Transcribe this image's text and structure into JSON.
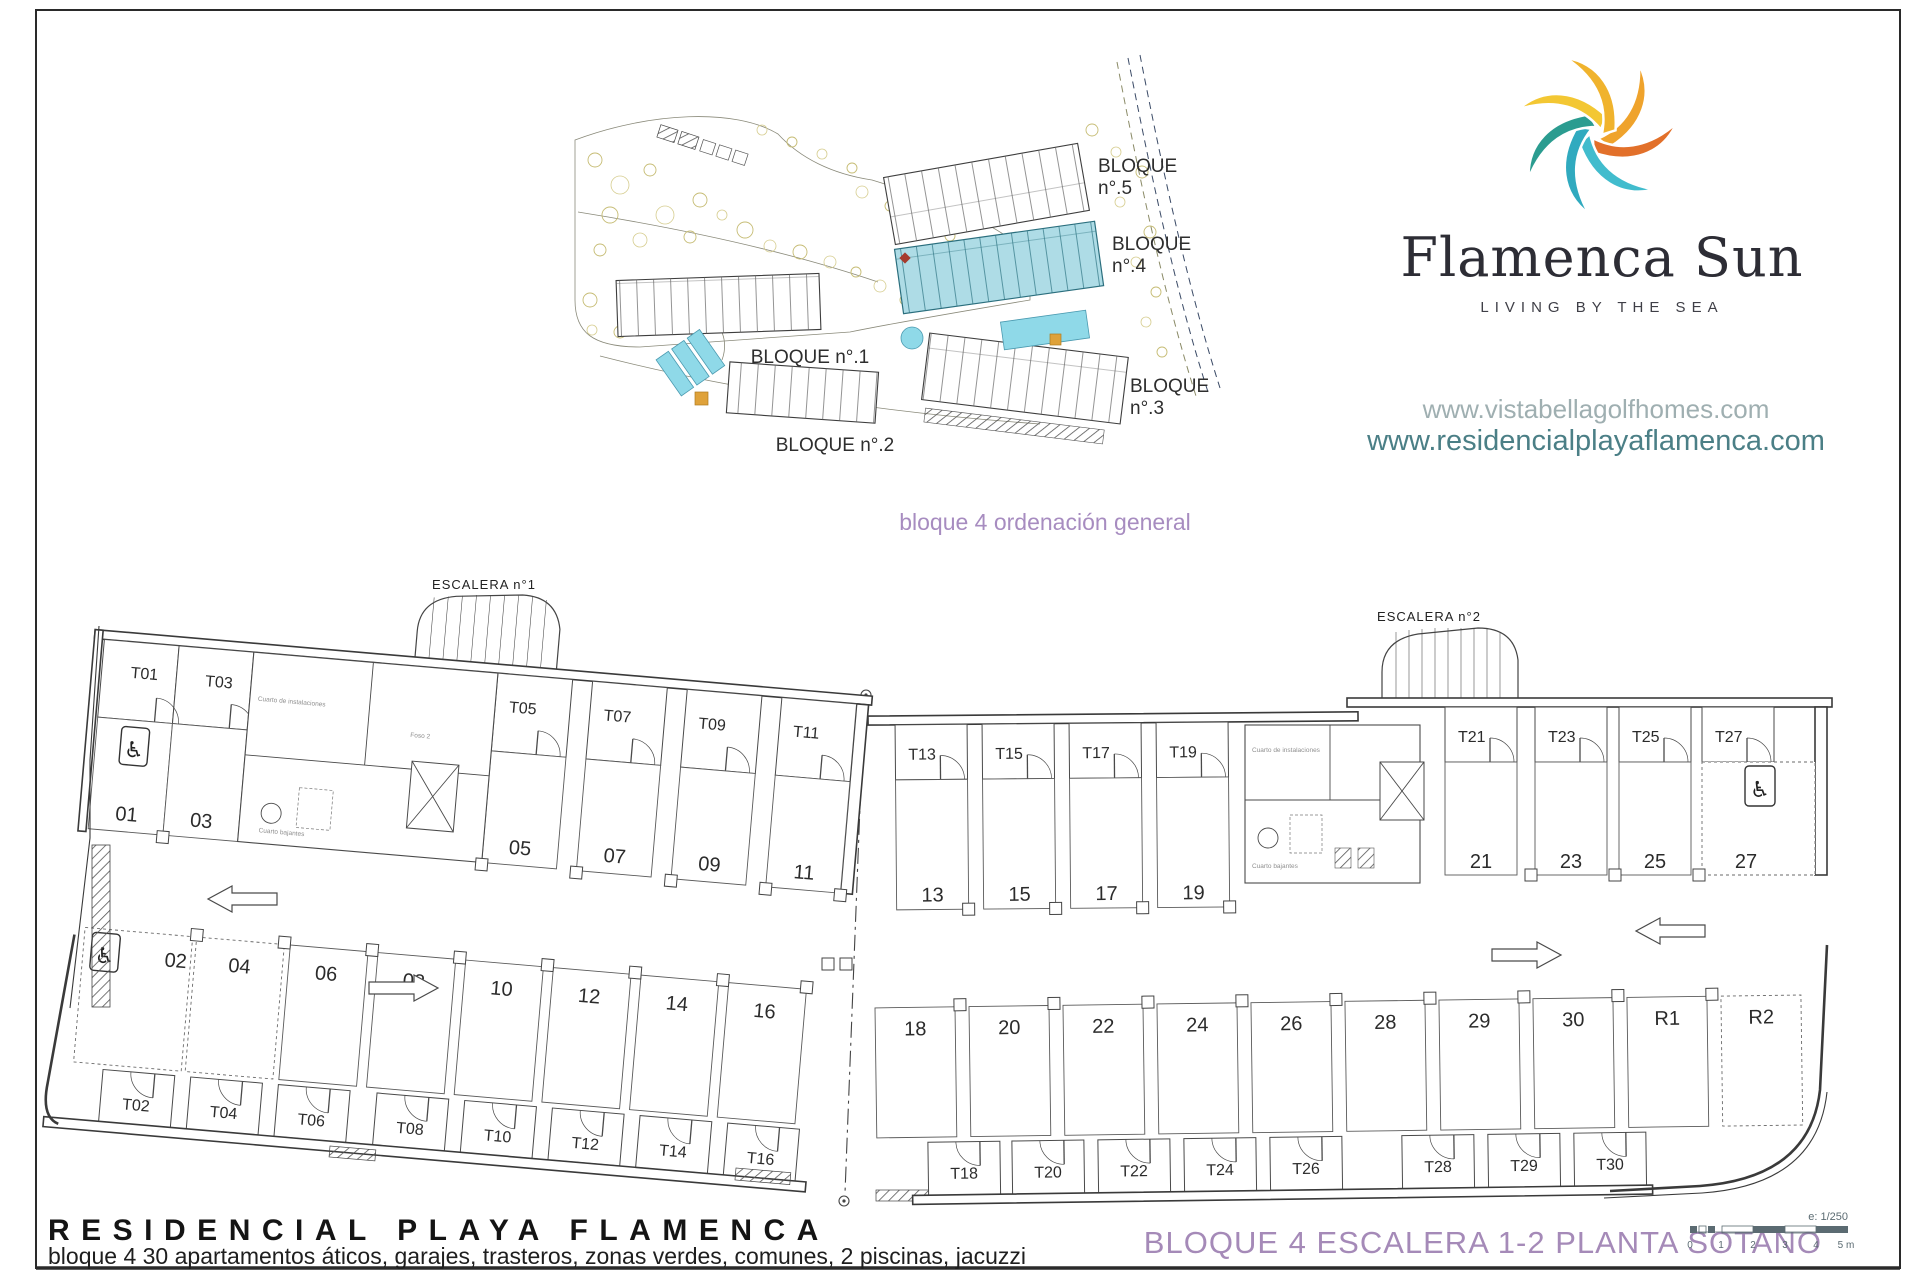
{
  "brand": {
    "name": "Flamenca Sun",
    "tagline": "LIVING BY THE SEA",
    "website_1": "www.vistabellagolfhomes.com",
    "website_2": "www.residencialplayaflamenca.com",
    "colors": {
      "orange": "#e2702a",
      "amber": "#efa32c",
      "yellow": "#f3c733",
      "teal": "#2b9c90",
      "cyan": "#30aabf",
      "sky": "#41bccd"
    }
  },
  "site_plan": {
    "caption": "bloque 4 ordenación general",
    "highlight_color": "#aedce6",
    "blocks": {
      "b1": {
        "l1": "BLOQUE n°.1"
      },
      "b2": {
        "l1": "BLOQUE n°.2"
      },
      "b3": {
        "l1": "BLOQUE",
        "l2": "n°.3"
      },
      "b4": {
        "l1": "BLOQUE",
        "l2": "n°.4"
      },
      "b5": {
        "l1": "BLOQUE",
        "l2": "n°.5"
      }
    }
  },
  "floor_plan": {
    "stair_1": "ESCALERA n°1",
    "stair_2": "ESCALERA n°2",
    "left_top_trasteros": [
      "T01",
      "T03",
      "T05",
      "T07",
      "T09",
      "T11"
    ],
    "left_top_parking": [
      "01",
      "03",
      "05",
      "07",
      "09",
      "11"
    ],
    "left_bottom_parking": [
      "02",
      "04",
      "06",
      "08",
      "10",
      "12",
      "14",
      "16"
    ],
    "left_bottom_trasteros": [
      "T02",
      "T04",
      "T06",
      "T08",
      "T10",
      "T12",
      "T14",
      "T16"
    ],
    "right_top_trasteros_a": [
      "T13",
      "T15",
      "T17",
      "T19"
    ],
    "right_top_parking_a": [
      "13",
      "15",
      "17",
      "19"
    ],
    "right_top_trasteros_b": [
      "T21",
      "T23",
      "T25",
      "T27"
    ],
    "right_top_parking_b": [
      "21",
      "23",
      "25",
      "27"
    ],
    "right_bottom_parking": [
      "18",
      "20",
      "22",
      "24",
      "26",
      "28",
      "29",
      "30",
      "R1",
      "R2"
    ],
    "right_bottom_trasteros": [
      "T18",
      "T20",
      "T22",
      "T24",
      "T26",
      "T28",
      "T29",
      "T30"
    ],
    "utility_labels_left": [
      "Cuarto de instalaciones",
      "Foso 2",
      "Cuarto bajantes"
    ],
    "utility_labels_right": [
      "Cuarto de instalaciones",
      "Foso 1",
      "Cuarto bajantes"
    ]
  },
  "icons": {
    "wheelchair": "♿"
  },
  "footer": {
    "project_title": "RESIDENCIAL PLAYA FLAMENCA",
    "project_subtitle": "bloque 4 30 apartamentos áticos, garajes, trasteros, zonas verdes, comunes, 2 piscinas, jacuzzi",
    "sheet_title": "BLOQUE 4 ESCALERA 1-2 PLANTA SOTANO",
    "scale_note": "e: 1/250",
    "scale_ticks": [
      "0",
      "1",
      "2",
      "3",
      "4",
      "5 m"
    ]
  }
}
